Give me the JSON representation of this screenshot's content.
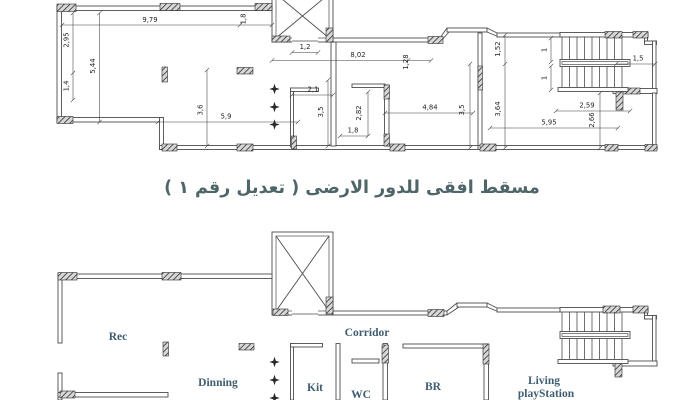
{
  "title": {
    "text": "مسقط افقى للدور الارضى ( تعديل رقم ١ )"
  },
  "colors": {
    "line": "#4d4d4d",
    "dim_text": "#1f1f1f",
    "room_label": "#3f5d70",
    "title": "#4f6668"
  },
  "icons": {
    "column_marker": "four-point-star",
    "shaft_marker": "x-cross"
  },
  "top_plan": {
    "dims": {
      "w979": "9,79",
      "v18": "1,8",
      "v295": "2,95",
      "v14": "1,4",
      "v544": "5,44",
      "v36": "3,6",
      "w59": "5,9",
      "w12": "1,2",
      "w802": "8,02",
      "v128": "1,28",
      "v152": "1,52",
      "w21": "2,1",
      "v35a": "3,5",
      "v282": "2,82",
      "w18": "1,8",
      "w484": "4,84",
      "v35b": "3,5",
      "v364": "3,64",
      "v1a": "1",
      "v1b": "1",
      "w259": "2,59",
      "w15": "1,5",
      "w595": "5,95",
      "v266": "2,66"
    }
  },
  "bottom_plan": {
    "rooms": {
      "rec": "Rec",
      "dinning": "Dinning",
      "corridor": "Corridor",
      "kit": "Kit",
      "wc": "WC",
      "br": "BR",
      "living_line1": "Living",
      "living_line2": "playStation"
    }
  }
}
